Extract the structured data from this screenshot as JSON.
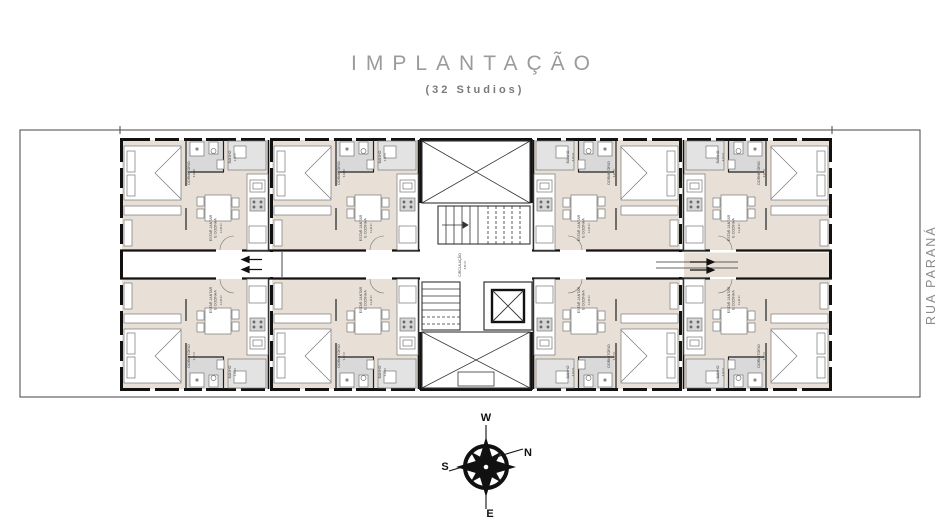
{
  "header": {
    "title": "IMPLANTAÇÃO",
    "subtitle": "(32 Studios)"
  },
  "street_label": "RUA PARANÁ",
  "compass": {
    "w": "W",
    "n": "N",
    "s": "S",
    "e": "E"
  },
  "rooms": {
    "dormitorio": {
      "lines": [
        "DORMITÓRIO"
      ],
      "area": "9,02 m²"
    },
    "banho": {
      "lines": [
        "BANHO"
      ],
      "area": "4,18 m²"
    },
    "estar": {
      "lines": [
        "ESTAR JANTAR",
        "E COZINHA"
      ],
      "area": "11,45 m²"
    },
    "circulacao": {
      "lines": [
        "CIRCULAÇÃO"
      ],
      "area": "6,60 m²"
    }
  },
  "units_count": 8,
  "colors": {
    "floor": "#e8e0d6",
    "bath": "#d9d9d9",
    "wall": "#111111",
    "thin_line": "#555555",
    "title_gray": "#9b9b9b"
  }
}
